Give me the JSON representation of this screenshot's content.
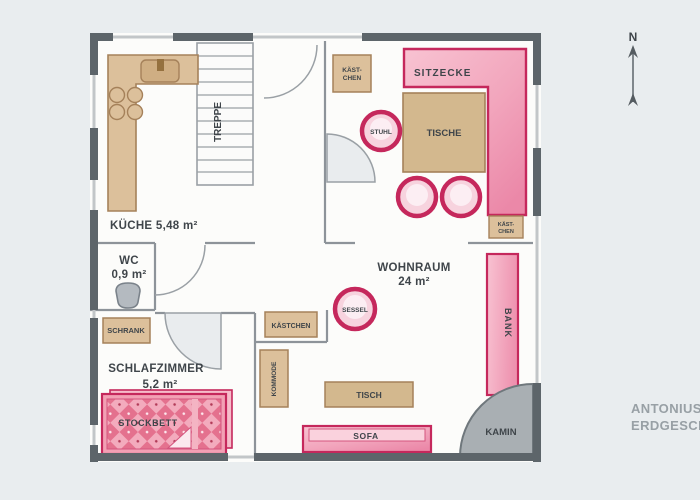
{
  "caption": {
    "line1": "ANTONIUS",
    "line2": "ERDGESCHOSS"
  },
  "compass": {
    "north_label": "N"
  },
  "rooms": {
    "kueche": {
      "label": "KÜCHE 5,48 m²"
    },
    "wc": {
      "name": "WC",
      "area": "0,9 m²"
    },
    "wohnraum": {
      "name": "WOHNRAUM",
      "area": "24 m²"
    },
    "schlafzimmer": {
      "name": "SCHLAFZIMMER",
      "area": "5,2 m²"
    }
  },
  "furniture": {
    "treppe": {
      "label": "TREPPE"
    },
    "kaestchen_entry": {
      "line1": "KÄST-",
      "line2": "CHEN"
    },
    "sitzecke": {
      "label": "SITZECKE"
    },
    "tische": {
      "label": "TISCHE"
    },
    "stuhl": {
      "label": "STUHL"
    },
    "kaestchen_right": {
      "line1": "KÄST-",
      "line2": "CHEN"
    },
    "kaestchen_flur": {
      "label": "KÄSTCHEN"
    },
    "kommode": {
      "label": "KOMMODE"
    },
    "schrank": {
      "label": "SCHRANK"
    },
    "stockbett": {
      "label": "STOCKBETT"
    },
    "sessel": {
      "label": "SESSEL"
    },
    "bank": {
      "label": "BANK"
    },
    "tisch": {
      "label": "TISCH"
    },
    "sofa": {
      "label": "SOFA"
    },
    "kamin": {
      "label": "KAMIN"
    }
  },
  "colors": {
    "page_background": "#e9edef",
    "wall_dark": "#5d656a",
    "window_light": "#c2c6c8",
    "interior_line": "#8d9399",
    "wood_tan": "#dcc09b",
    "wood_border": "#a5815a",
    "pink_fill": "#f2a6bd",
    "pink_border": "#c5285c",
    "gray_object": "#a9afb3"
  }
}
